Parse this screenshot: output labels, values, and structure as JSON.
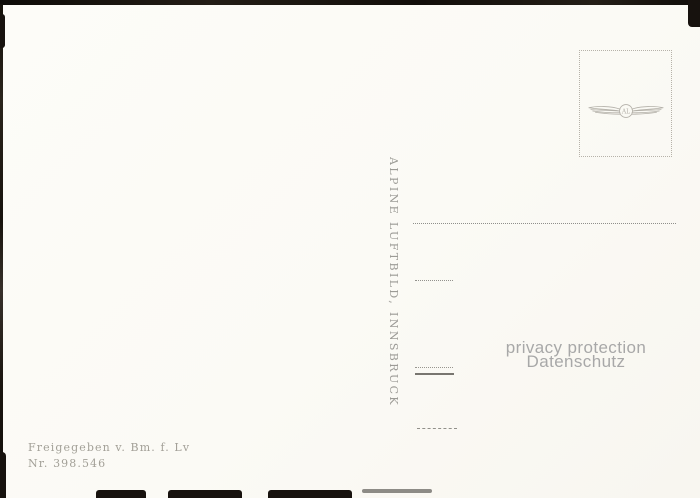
{
  "card": {
    "type_note": "postcard back (blank correspondence side)",
    "publisher_vertical_text": "ALPINE LUFTBILD, INNSBRUCK",
    "approval": {
      "line1": "Freigegeben v. Bm. f. Lv",
      "line2": "Nr. 398.546"
    },
    "stamp_box": {
      "emblem": "winged-circle-emblem",
      "monogram": "AL"
    }
  },
  "watermark": {
    "line1": "privacy protection",
    "line2": "Datenschutz"
  },
  "colors": {
    "card_background": "#fdfcf8",
    "photo_background": "#17120e",
    "ink_grey": "#9c9b96",
    "watermark_grey": "#a8a8a8",
    "stamp_border": "#b6b2a9"
  }
}
